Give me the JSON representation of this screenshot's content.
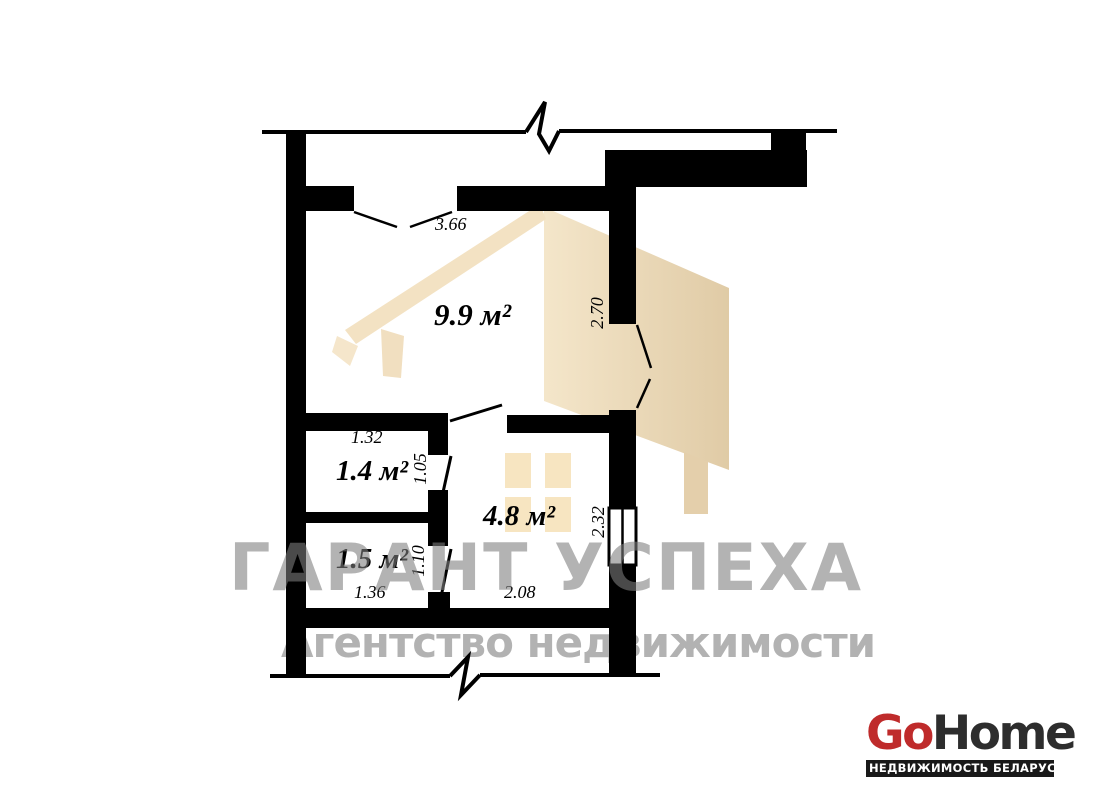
{
  "floorplan": {
    "rooms": [
      {
        "id": "room-9-9",
        "area_label": "9.9 м²"
      },
      {
        "id": "room-1-4",
        "area_label": "1.4 м²"
      },
      {
        "id": "room-1-5",
        "area_label": "1.5 м²"
      },
      {
        "id": "room-4-8",
        "area_label": "4.8 м²"
      }
    ],
    "dimensions": [
      {
        "id": "dim-3-66",
        "label": "3.66",
        "orientation": "horizontal"
      },
      {
        "id": "dim-2-70",
        "label": "2.70",
        "orientation": "vertical"
      },
      {
        "id": "dim-1-32",
        "label": "1.32",
        "orientation": "horizontal"
      },
      {
        "id": "dim-1-05",
        "label": "1.05",
        "orientation": "vertical"
      },
      {
        "id": "dim-1-10",
        "label": "1.10",
        "orientation": "vertical"
      },
      {
        "id": "dim-1-36",
        "label": "1.36",
        "orientation": "horizontal"
      },
      {
        "id": "dim-2-08",
        "label": "2.08",
        "orientation": "horizontal"
      },
      {
        "id": "dim-2-32",
        "label": "2.32",
        "orientation": "vertical"
      }
    ],
    "wall_color": "#000000",
    "background_color": "#ffffff"
  },
  "watermark": {
    "agency_name": "ГАРАНТ УСПЕХА",
    "agency_subtitle": "Агентство недвижимости",
    "text_color": "#b2b2b2",
    "house_color": "#ecd9b8"
  },
  "logo": {
    "brand_go": "Go",
    "brand_home": "Home",
    "tagline": "НЕДВИЖИМОСТЬ БЕЛАРУСИ",
    "go_color": "#bf2b2b",
    "home_color": "#2d2d2d",
    "tagline_bg": "#191919",
    "tagline_text_color": "#ffffff"
  }
}
